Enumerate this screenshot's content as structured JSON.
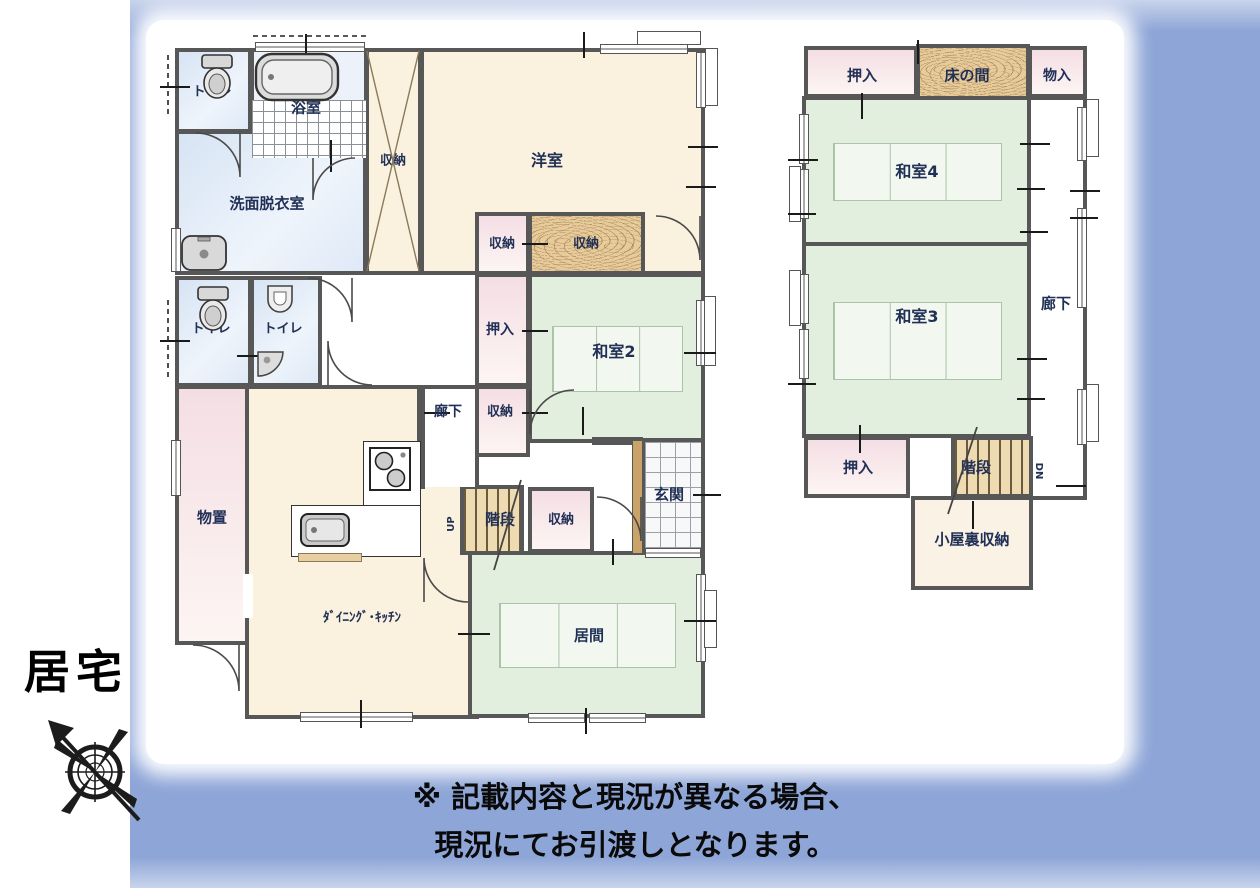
{
  "page": {
    "property_label": "居宅",
    "disclaimer_line1": "※ 記載内容と現況が異なる場合、",
    "disclaimer_line2": "現況にてお引渡しとなります。"
  },
  "palette": {
    "frame_blue": "#8da5d7",
    "wall_gray": "#575757",
    "tatami_green": "#e2efdf",
    "cream": "#faf1de",
    "closet_pink": "#f4dee4",
    "water_blue": "#d7e4f4",
    "wood_tan": "#e7cb9b",
    "stair_wood": "#eedbb2",
    "label_navy": "#213056"
  },
  "floor1": {
    "toilet1": "トイレ",
    "bath": "浴室",
    "washroom": "洗面脱衣室",
    "closet_tall": "収納",
    "western_room": "洋室",
    "closet_mid": "収納",
    "closet_wood": "収納",
    "oshiire": "押入",
    "washitsu2": "和室2",
    "closet_low": "収納",
    "hallway": "廊下",
    "toilet2": "トイレ",
    "toilet3": "トイレ",
    "storeroom": "物置",
    "dining_kitchen": "ﾀﾞｲﾆﾝｸﾞ･ｷｯﾁﾝ",
    "stairs": "階段",
    "stairs_dir": "UP",
    "closet_stairs": "収納",
    "entrance": "玄関",
    "living": "居間"
  },
  "floor2": {
    "oshiire_top": "押入",
    "tokonoma": "床の間",
    "monoiri": "物入",
    "washitsu4": "和室4",
    "washitsu3": "和室3",
    "corridor": "廊下",
    "oshiire_bottom": "押入",
    "stairs": "階段",
    "stairs_dir": "DN",
    "attic": "小屋裏収納"
  }
}
